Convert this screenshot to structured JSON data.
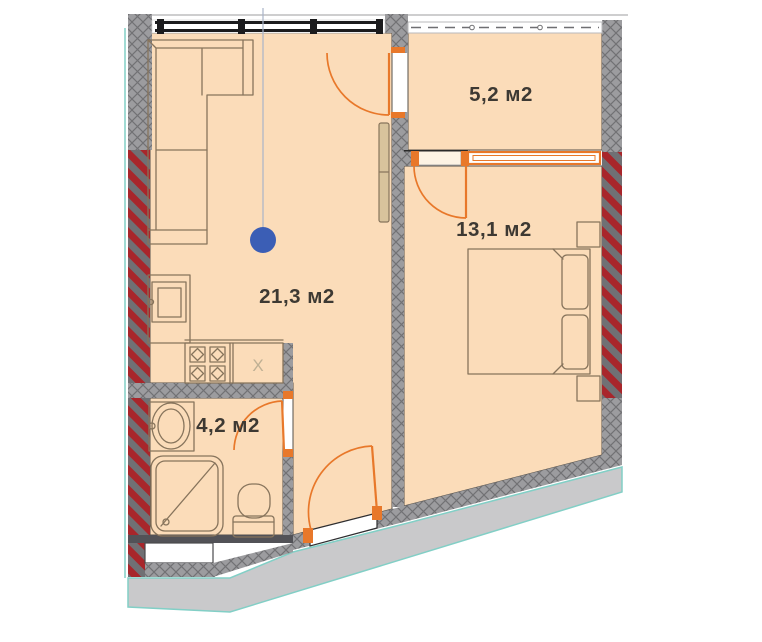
{
  "meta": {
    "type": "apartment-floor-plan"
  },
  "rooms": [
    {
      "id": "living-kitchen",
      "area_label": "21,3 м2"
    },
    {
      "id": "bedroom",
      "area_label": "13,1 м2"
    },
    {
      "id": "balcony",
      "area_label": "5,2 м2"
    },
    {
      "id": "bathroom",
      "area_label": "4,2 м2"
    }
  ],
  "annotations": {
    "counter_mark": "X"
  },
  "colors": {
    "floor": "#fbdcb9",
    "wall": "#9c9c9f",
    "wall-line": "#717174",
    "wall-dark": "#707074",
    "red": "#a8262b",
    "door": "#e8782a",
    "terrace": "#c9c9cb",
    "teal": "#82cfc6",
    "blue": "#3b5eb5",
    "text": "#3d3933",
    "outline": "#55504a",
    "furniture": "#87745c",
    "wardrobe": "#d8c39c",
    "faint": "#bfb094"
  }
}
